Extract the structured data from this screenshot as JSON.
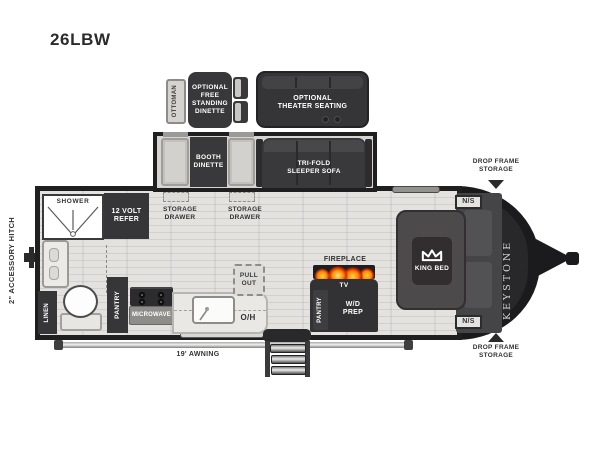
{
  "title": "26LBW",
  "hitch_label": "2\" ACCESSORY HITCH",
  "brand": "KEYSTONE",
  "optional_items": {
    "ottoman": "OTTOMAN",
    "free_standing_dinette": "OPTIONAL\nFREE\nSTANDING\nDINETTE",
    "theater_seating": "OPTIONAL\nTHEATER SEATING"
  },
  "slide_out": {
    "booth_dinette": "BOOTH\nDINETTE",
    "sleeper_sofa": "TRI-FOLD\nSLEEPER SOFA",
    "storage_drawer_left": "STORAGE\nDRAWER",
    "storage_drawer_right": "STORAGE\nDRAWER"
  },
  "bathroom": {
    "shower": "SHOWER",
    "refer": "12 VOLT\nREFER",
    "linen": "LINEN"
  },
  "kitchen": {
    "pantry": "PANTRY",
    "microwave": "MICROWAVE",
    "overhead": "O/H",
    "pull_out": "PULL\nOUT"
  },
  "entertainment": {
    "fireplace": "FIREPLACE",
    "tv": "TV",
    "pantry": "PANTRY",
    "wd_prep": "W/D\nPREP"
  },
  "bedroom": {
    "king_bed": "KING BED",
    "nightstand_top": "N/S",
    "nightstand_bottom": "N/S"
  },
  "exterior": {
    "awning": "19' AWNING",
    "drop_frame_storage_top": "DROP FRAME\nSTORAGE",
    "drop_frame_storage_bottom": "DROP FRAME\nSTORAGE"
  },
  "colors": {
    "wall": "#1f1f1f",
    "dark_fixture": "#39393b",
    "floor": "#e3e2df",
    "light_fixture": "#d6d4d1",
    "flame": "#ff8a00",
    "label_text": "#323232"
  }
}
